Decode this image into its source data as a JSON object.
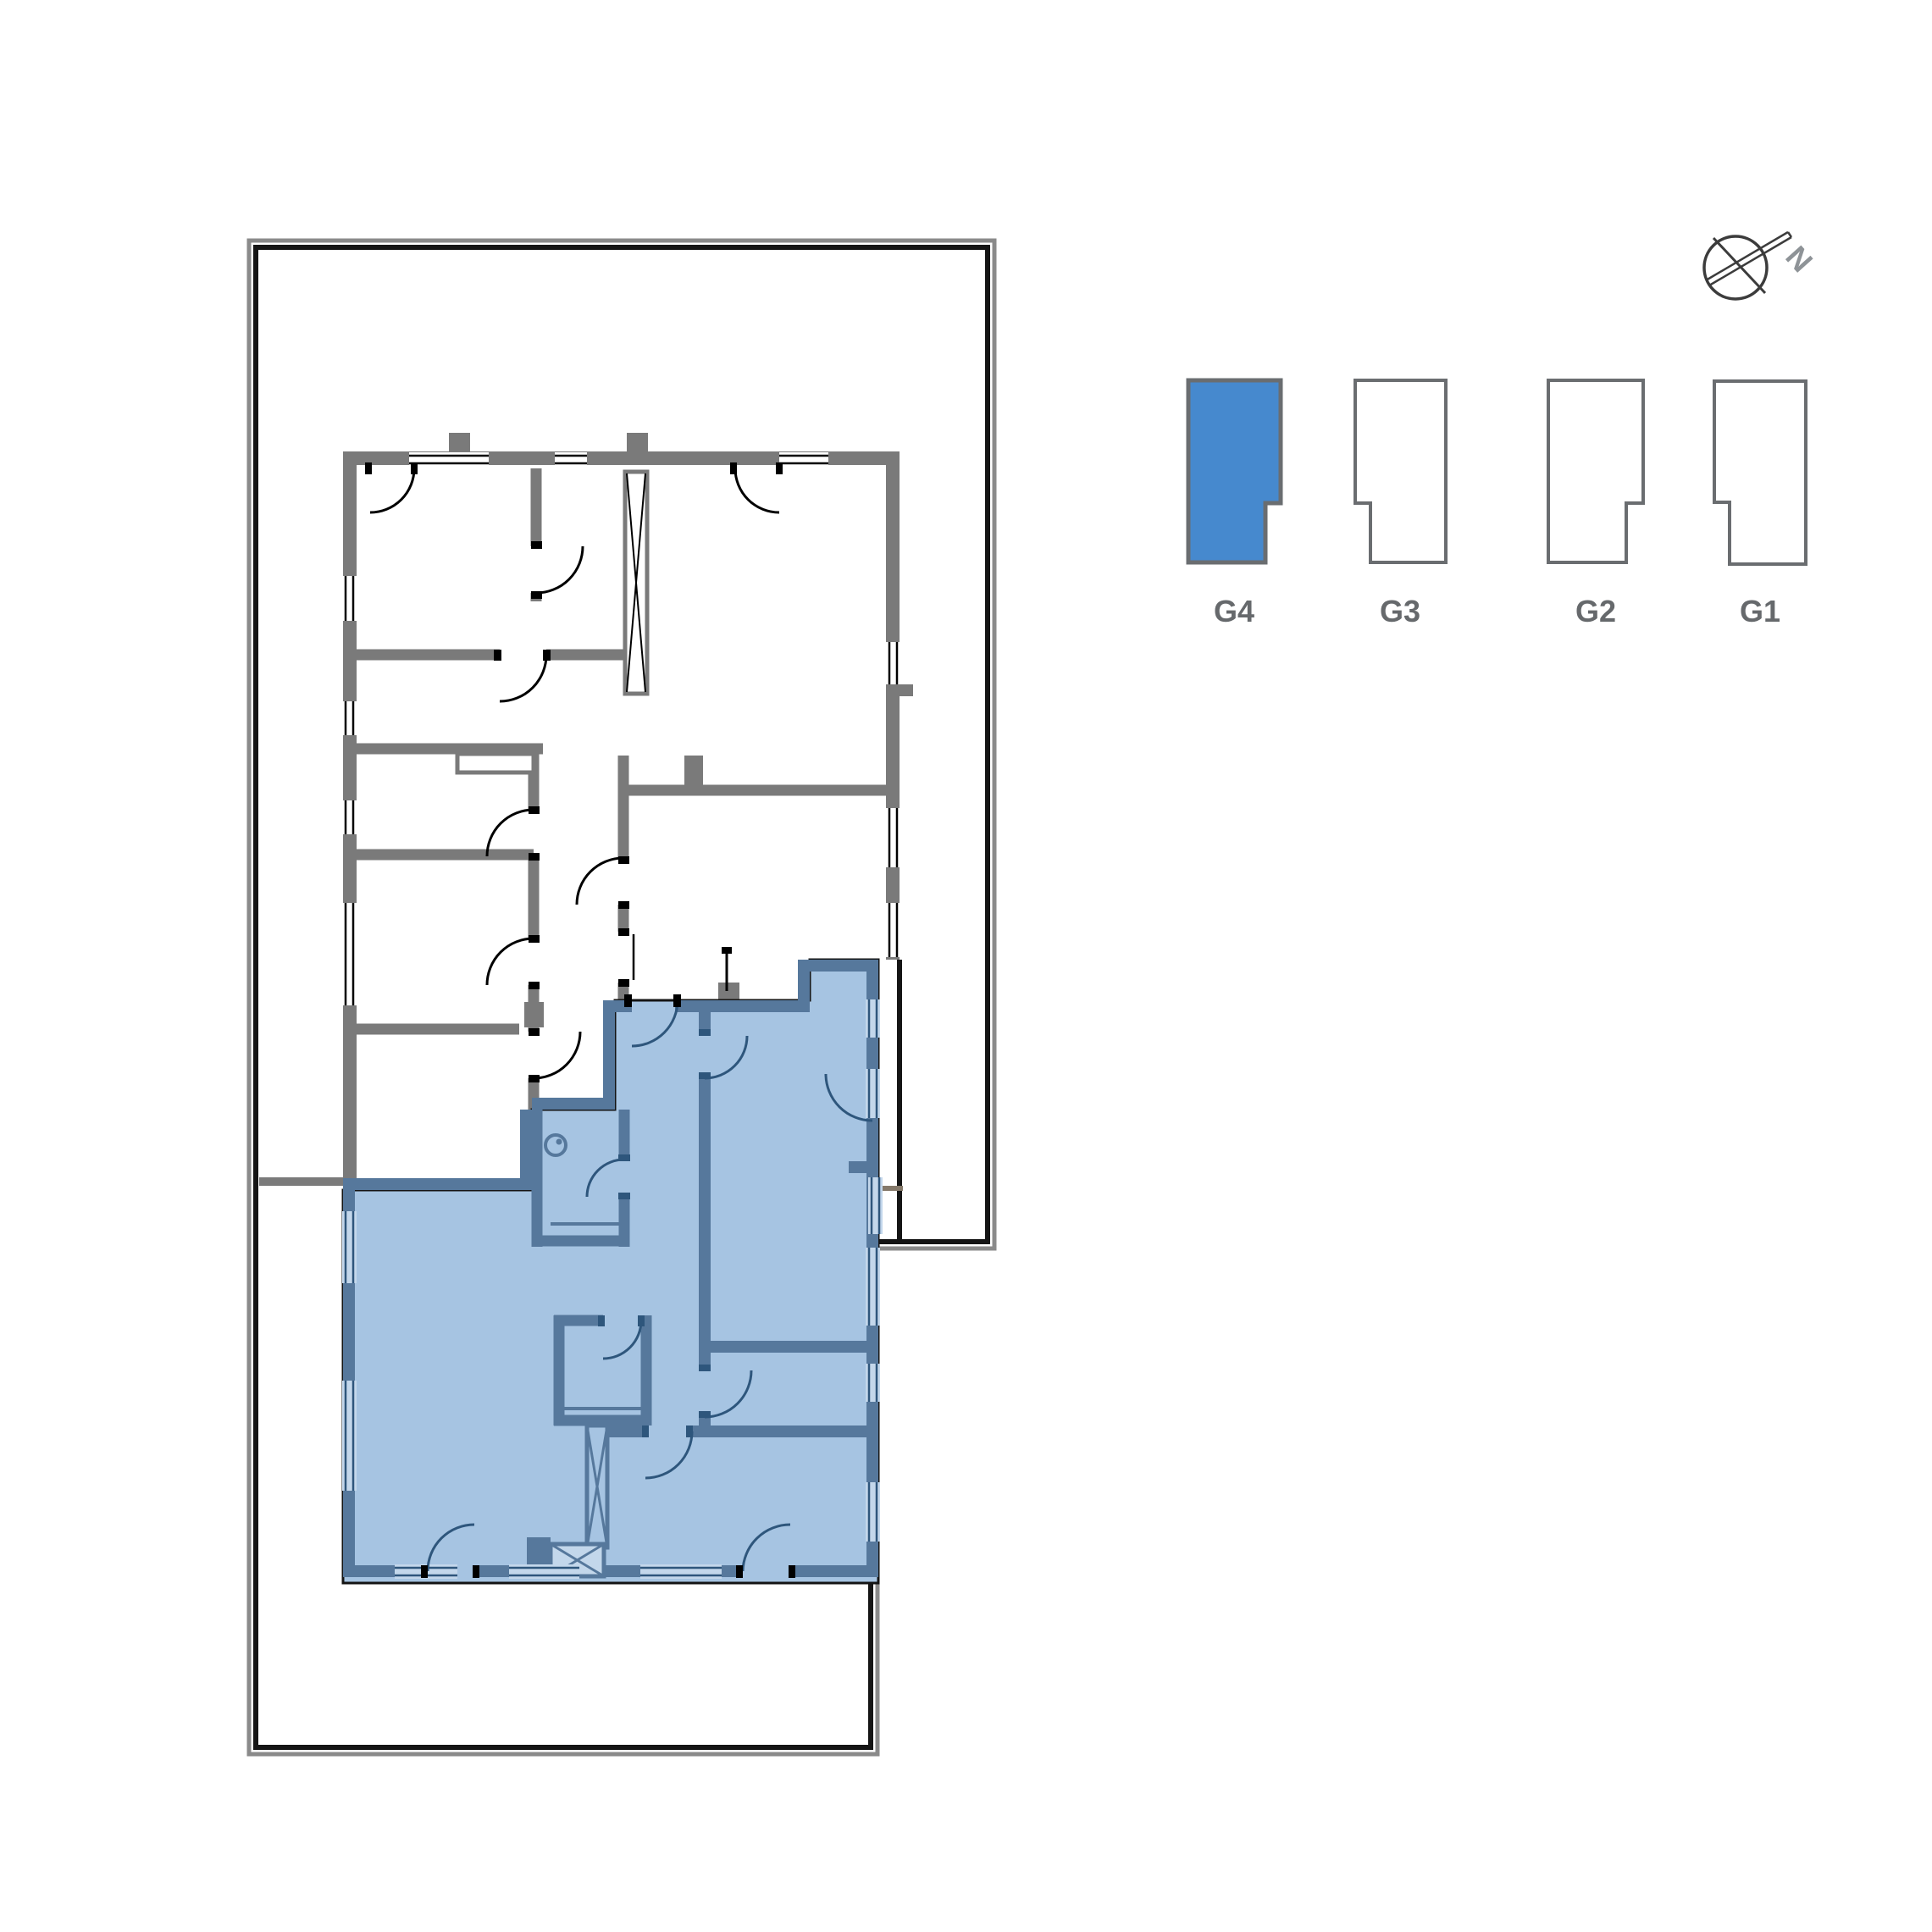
{
  "legend": {
    "label_color": "#66696c",
    "units": [
      {
        "label": "G4",
        "selected": true,
        "fill": "#4689ce",
        "stroke": "#6a6d70"
      },
      {
        "label": "G3",
        "selected": false,
        "fill": "#ffffff",
        "stroke": "#6a6d70"
      },
      {
        "label": "G2",
        "selected": false,
        "fill": "#ffffff",
        "stroke": "#6a6d70"
      },
      {
        "label": "G1",
        "selected": false,
        "fill": "#ffffff",
        "stroke": "#6a6d70"
      }
    ]
  },
  "compass": {
    "label": "N",
    "letter_color": "#8e9397",
    "ring_color": "#3c3c3c"
  },
  "floorplan": {
    "highlighted_unit": "G4",
    "colors": {
      "site_boundary": "#151515",
      "boundary_outer": "#8a8a8a",
      "wall_gray": "#7a7a7a",
      "unit_fill": "#a6c4e2",
      "unit_wall": "#56789c",
      "unit_dark": "#2e567c",
      "window_light": "#c3d7eb",
      "fence_line": "#85796a",
      "room_fill": "#ffffff"
    }
  }
}
